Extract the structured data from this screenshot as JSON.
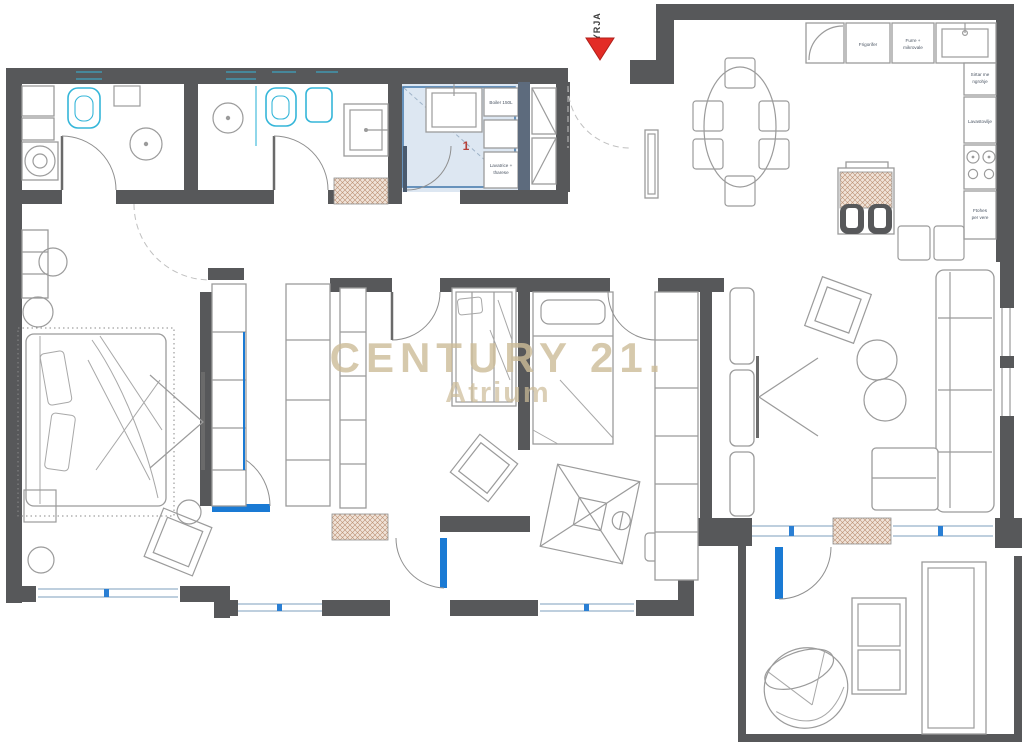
{
  "watermark": {
    "line1": "CENTURY 21.",
    "line2": "Atrium"
  },
  "entry": {
    "label": "HYRJA"
  },
  "utility_room": {
    "number": "1",
    "boiler_label": "Boiler 150L",
    "washer_label_line1": "Lavatrice +",
    "washer_label_line2": "tharese"
  },
  "kitchen": {
    "fridge_label": "Frigorifer",
    "oven_label_line1": "Furre +",
    "oven_label_line2": "mikrovale",
    "drawer_label_line1": "Sirtar me",
    "drawer_label_line2": "ngrohje",
    "dishwasher_label": "Lavastovilje",
    "wine_label_line1": "Ftohes",
    "wine_label_line2": "per vere"
  },
  "colors": {
    "wall": "#57585a",
    "fixture_cyan": "#35b6d9",
    "door_blue": "#1a7ad4",
    "utility_fill": "#dde7f2",
    "utility_border": "#4a7dae",
    "hatch_line": "#bb8f72",
    "watermark": "#cdbc98",
    "arrow_red": "#e32c26",
    "number_red": "#b5413a"
  }
}
